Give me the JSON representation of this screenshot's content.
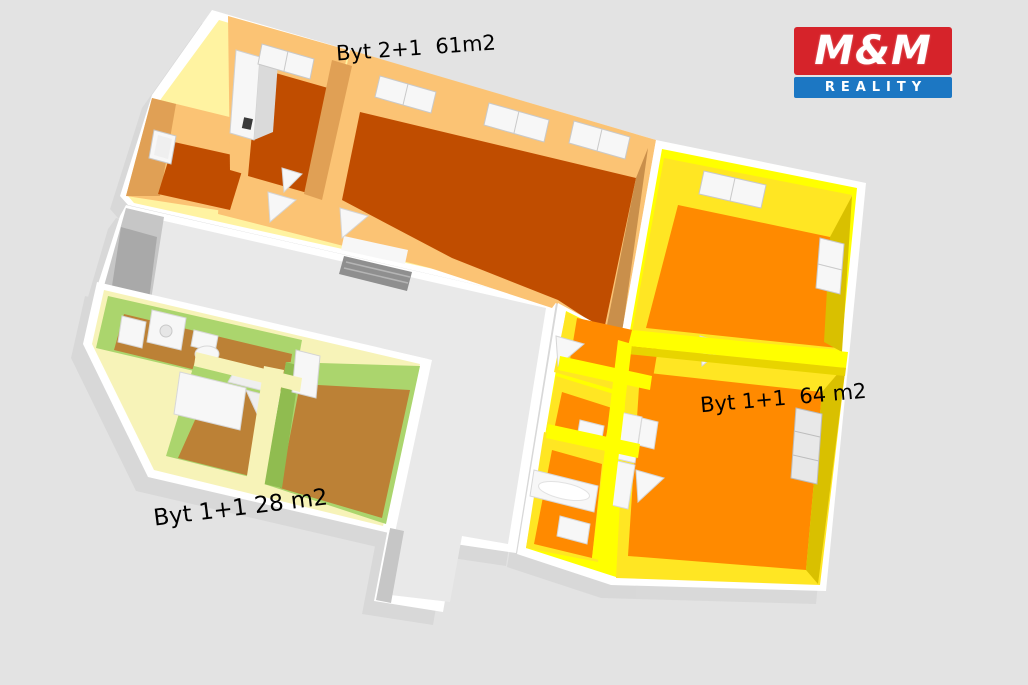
{
  "scene": {
    "description": "3D rendered floor plan of one building level with three apartments and a shared corridor",
    "width": 1028,
    "height": 685
  },
  "labels": {
    "apartment_top": "Byt 2+1  61m2",
    "apartment_right": "Byt 1+1  64 m2",
    "apartment_bottom": "Byt 1+1 28 m2"
  },
  "logo": {
    "title": "M&M",
    "subtitle": "REALITY"
  },
  "colors": {
    "page-bg": "#E3E3E3",
    "shadow": "#D7D7D7",
    "wall-white": "#FFFFFF",
    "corridor-floor": "#E9E9E9",
    "corridor-wall-face": "#C6C6C6",
    "door-gray": "#A9A9A9",
    "stairs-gray": "#8F8F8F",
    "apt1-band": "#FFF3A1",
    "apt1-wall": "#FBC374",
    "apt1-wall-dark": "#E0A055",
    "apt1-wall-darker": "#C98F4B",
    "apt1-floor": "#C04D00",
    "apt2-band": "#FFFF00",
    "apt2-wall": "#FFE623",
    "apt2-wall-dark": "#E8D400",
    "apt2-wall-darker": "#D9C000",
    "apt2-floor": "#FF8A00",
    "apt3-band": "#F7F3B8",
    "apt3-wall": "#ABD56D",
    "apt3-wall-dark": "#90BC50",
    "apt3-floor": "#BC8136",
    "fixture-white": "#F7F7F7",
    "fixture-edge": "#CFCFCF",
    "window-pane": "#EFEFEF",
    "label-text": "#000000",
    "logo-red": "#D6232A",
    "logo-blue": "#1C77C3"
  }
}
